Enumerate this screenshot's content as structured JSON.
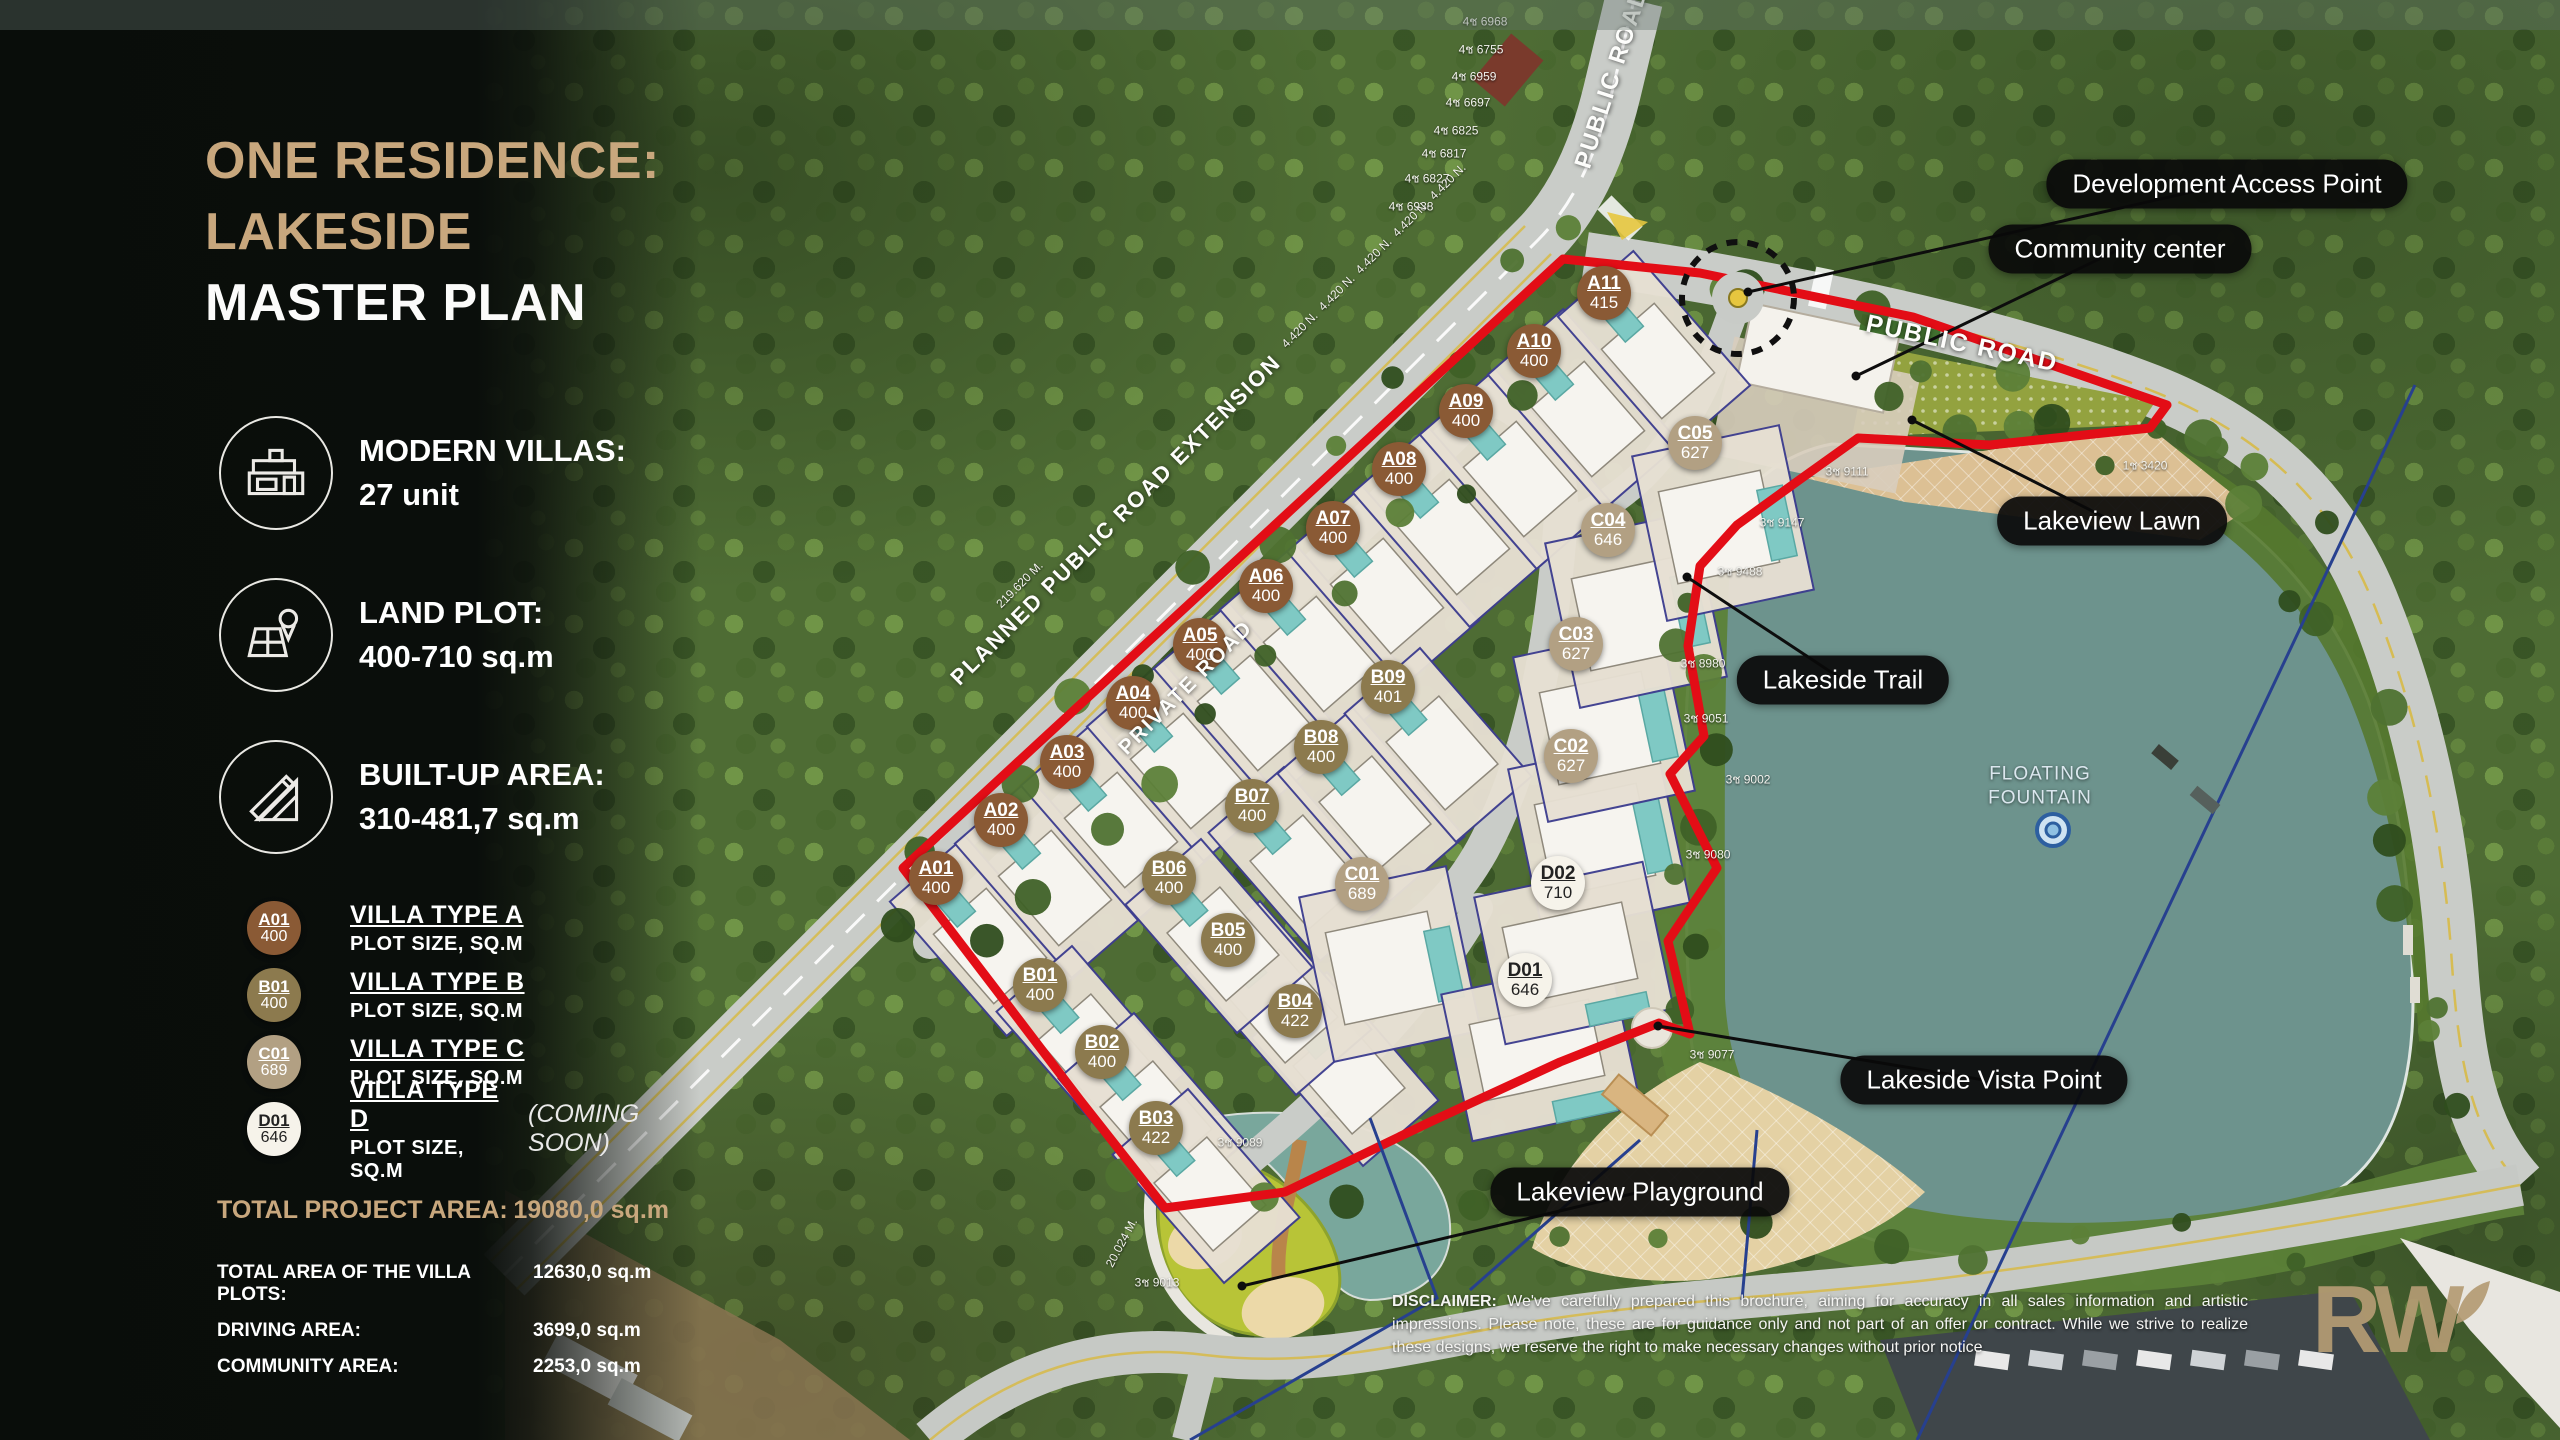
{
  "colors": {
    "accent_tan": "#c8a77d",
    "boundary_red": "#e30d16",
    "lake": "#6d938d",
    "type_a": "#8a5a35",
    "type_b": "#8c7a4e",
    "type_c": "#b2a083",
    "type_d": "#f6f3ea"
  },
  "sidebar": {
    "title_line1": "ONE RESIDENCE:",
    "title_line2": "LAKESIDE",
    "title_line3": "MASTER PLAN",
    "features": [
      {
        "icon": "villa-icon",
        "label": "MODERN VILLAS:",
        "value": "27 unit"
      },
      {
        "icon": "land-plot-icon",
        "label": "LAND PLOT:",
        "value": "400-710 sq.m"
      },
      {
        "icon": "built-up-icon",
        "label": "BUILT-UP AREA:",
        "value": "310-481,7 sq.m"
      }
    ],
    "legend": [
      {
        "badge_id": "A01",
        "badge_size": "400",
        "type": "a",
        "title": "VILLA TYPE A",
        "subtitle": "PLOT SIZE, SQ.M",
        "note": ""
      },
      {
        "badge_id": "B01",
        "badge_size": "400",
        "type": "b",
        "title": "VILLA TYPE B",
        "subtitle": "PLOT SIZE, SQ.M",
        "note": ""
      },
      {
        "badge_id": "C01",
        "badge_size": "689",
        "type": "c",
        "title": "VILLA TYPE C",
        "subtitle": "PLOT SIZE, SQ.M",
        "note": ""
      },
      {
        "badge_id": "D01",
        "badge_size": "646",
        "type": "d",
        "title": "VILLA TYPE D",
        "subtitle": "PLOT SIZE, SQ.M",
        "note": "(COMING SOON)"
      }
    ],
    "totals_primary": {
      "label": "TOTAL PROJECT AREA:",
      "value": "19080,0 sq.m"
    },
    "totals": [
      {
        "label": "TOTAL AREA OF THE VILLA PLOTS:",
        "value": "12630,0 sq.m"
      },
      {
        "label": "DRIVING AREA:",
        "value": "3699,0 sq.m"
      },
      {
        "label": "COMMUNITY AREA:",
        "value": "2253,0 sq.m"
      }
    ]
  },
  "map": {
    "plots": [
      {
        "id": "A01",
        "size": "400",
        "type": "a",
        "x": 936,
        "y": 878
      },
      {
        "id": "A02",
        "size": "400",
        "type": "a",
        "x": 1001,
        "y": 820
      },
      {
        "id": "A03",
        "size": "400",
        "type": "a",
        "x": 1067,
        "y": 762
      },
      {
        "id": "A04",
        "size": "400",
        "type": "a",
        "x": 1133,
        "y": 703
      },
      {
        "id": "A05",
        "size": "400",
        "type": "a",
        "x": 1200,
        "y": 645
      },
      {
        "id": "A06",
        "size": "400",
        "type": "a",
        "x": 1266,
        "y": 586
      },
      {
        "id": "A07",
        "size": "400",
        "type": "a",
        "x": 1333,
        "y": 528
      },
      {
        "id": "A08",
        "size": "400",
        "type": "a",
        "x": 1399,
        "y": 469
      },
      {
        "id": "A09",
        "size": "400",
        "type": "a",
        "x": 1466,
        "y": 411
      },
      {
        "id": "A10",
        "size": "400",
        "type": "a",
        "x": 1534,
        "y": 351
      },
      {
        "id": "A11",
        "size": "415",
        "type": "a",
        "x": 1604,
        "y": 293
      },
      {
        "id": "B01",
        "size": "400",
        "type": "b",
        "x": 1040,
        "y": 985
      },
      {
        "id": "B02",
        "size": "400",
        "type": "b",
        "x": 1102,
        "y": 1052
      },
      {
        "id": "B03",
        "size": "422",
        "type": "b",
        "x": 1156,
        "y": 1128
      },
      {
        "id": "B04",
        "size": "422",
        "type": "b",
        "x": 1295,
        "y": 1011
      },
      {
        "id": "B05",
        "size": "400",
        "type": "b",
        "x": 1228,
        "y": 940
      },
      {
        "id": "B06",
        "size": "400",
        "type": "b",
        "x": 1169,
        "y": 878
      },
      {
        "id": "B07",
        "size": "400",
        "type": "b",
        "x": 1252,
        "y": 806
      },
      {
        "id": "B08",
        "size": "400",
        "type": "b",
        "x": 1321,
        "y": 747
      },
      {
        "id": "B09",
        "size": "401",
        "type": "b",
        "x": 1388,
        "y": 687
      },
      {
        "id": "C01",
        "size": "689",
        "type": "c",
        "x": 1362,
        "y": 884
      },
      {
        "id": "C02",
        "size": "627",
        "type": "c",
        "x": 1571,
        "y": 756
      },
      {
        "id": "C03",
        "size": "627",
        "type": "c",
        "x": 1576,
        "y": 644
      },
      {
        "id": "C04",
        "size": "646",
        "type": "c",
        "x": 1608,
        "y": 530
      },
      {
        "id": "C05",
        "size": "627",
        "type": "c",
        "x": 1695,
        "y": 443
      },
      {
        "id": "D01",
        "size": "646",
        "type": "d",
        "x": 1525,
        "y": 980
      },
      {
        "id": "D02",
        "size": "710",
        "type": "d",
        "x": 1558,
        "y": 883
      }
    ],
    "callouts": [
      {
        "text": "Development Access Point",
        "x": 2227,
        "y": 184,
        "lx": 1748,
        "ly": 292
      },
      {
        "text": "Community center",
        "x": 2120,
        "y": 249,
        "lx": 1856,
        "ly": 376
      },
      {
        "text": "Lakeview Lawn",
        "x": 2112,
        "y": 521,
        "lx": 1912,
        "ly": 420
      },
      {
        "text": "Lakeside Trail",
        "x": 1843,
        "y": 680,
        "lx": 1687,
        "ly": 577
      },
      {
        "text": "Lakeside Vista Point",
        "x": 1984,
        "y": 1080,
        "lx": 1658,
        "ly": 1026
      },
      {
        "text": "Lakeview Playground",
        "x": 1640,
        "y": 1192,
        "lx": 1242,
        "ly": 1286
      }
    ],
    "road_labels": [
      {
        "text": "PUBLIC ROAD",
        "x": 1612,
        "y": 78,
        "rot": -72,
        "size": 24
      },
      {
        "text": "PUBLIC ROAD",
        "x": 1962,
        "y": 344,
        "rot": 12,
        "size": 25
      },
      {
        "text": "PLANNED PUBLIC ROAD EXTENSION",
        "x": 1116,
        "y": 520,
        "rot": -45,
        "size": 22
      },
      {
        "text": "PRIVATE ROAD",
        "x": 1186,
        "y": 688,
        "rot": -45,
        "size": 21
      }
    ],
    "fountain": {
      "label_line1": "FLOATING",
      "label_line2": "FOUNTAIN",
      "x": 2040,
      "y": 786
    },
    "survey_marks": [
      {
        "text": "3ช 9111",
        "x": 1847,
        "y": 472,
        "rot": 0
      },
      {
        "text": "3ช 9147",
        "x": 1782,
        "y": 523,
        "rot": 0
      },
      {
        "text": "3ช 9488",
        "x": 1740,
        "y": 572,
        "rot": 0
      },
      {
        "text": "3ช 8980",
        "x": 1703,
        "y": 664,
        "rot": 0
      },
      {
        "text": "3ช 9051",
        "x": 1706,
        "y": 719,
        "rot": 0
      },
      {
        "text": "3ช 9002",
        "x": 1748,
        "y": 780,
        "rot": 0
      },
      {
        "text": "3ช 9080",
        "x": 1708,
        "y": 855,
        "rot": 0
      },
      {
        "text": "3ช 9077",
        "x": 1712,
        "y": 1055,
        "rot": 0
      },
      {
        "text": "3ช 9013",
        "x": 1157,
        "y": 1283,
        "rot": 0
      },
      {
        "text": "3ช 9089",
        "x": 1240,
        "y": 1143,
        "rot": 0
      },
      {
        "text": "1ช 3420",
        "x": 2145,
        "y": 466,
        "rot": 0
      },
      {
        "text": "4ช 6968",
        "x": 1485,
        "y": 22,
        "rot": 0
      },
      {
        "text": "4ช 6755",
        "x": 1481,
        "y": 50,
        "rot": 0
      },
      {
        "text": "4ช 6959",
        "x": 1474,
        "y": 77,
        "rot": 0
      },
      {
        "text": "4ช 6697",
        "x": 1468,
        "y": 103,
        "rot": 0
      },
      {
        "text": "4ช 6825",
        "x": 1456,
        "y": 131,
        "rot": 0
      },
      {
        "text": "4ช 6817",
        "x": 1444,
        "y": 154,
        "rot": 0
      },
      {
        "text": "4ช 6827",
        "x": 1427,
        "y": 179,
        "rot": 0
      },
      {
        "text": "4ช 6938",
        "x": 1411,
        "y": 207,
        "rot": 0
      },
      {
        "text": "4.420 N.",
        "x": 1300,
        "y": 330,
        "rot": -45
      },
      {
        "text": "4.420 N.",
        "x": 1337,
        "y": 293,
        "rot": -45
      },
      {
        "text": "4.420 N.",
        "x": 1374,
        "y": 256,
        "rot": -45
      },
      {
        "text": "4.420 N.",
        "x": 1411,
        "y": 219,
        "rot": -45
      },
      {
        "text": "4.420 N.",
        "x": 1448,
        "y": 182,
        "rot": -45
      },
      {
        "text": "219.620 M.",
        "x": 1020,
        "y": 585,
        "rot": -45
      },
      {
        "text": "20.024 M.",
        "x": 1122,
        "y": 1243,
        "rot": -62
      }
    ],
    "disclaimer": {
      "lead": "DISCLAIMER:",
      "body": " We've carefully prepared this brochure, aiming for accuracy in all sales information and artistic impressions. Please note, these are for guidance only and not part of an offer or contract. While we strive to realize these designs, we reserve the right to make necessary changes without prior notice"
    },
    "brand": "RW"
  }
}
